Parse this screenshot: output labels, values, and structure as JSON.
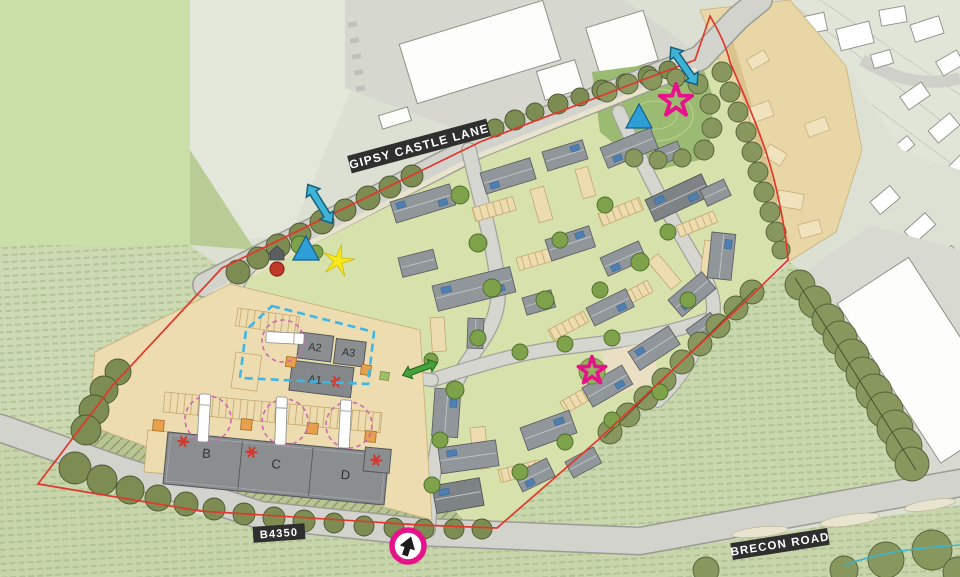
{
  "plan": {
    "road_labels": {
      "gipsy_castle_lane": "GIPSY CASTLE LANE",
      "b4350": "B4350",
      "brecon_road": "BRECON ROAD"
    },
    "building_labels": {
      "a1": "A1",
      "a2": "A2",
      "a3": "A3",
      "b": "B",
      "c": "C",
      "d": "D"
    },
    "markers": {
      "site_boundary": {
        "name": "site-boundary-line",
        "color": "#e0382c",
        "style": "solid"
      },
      "secondary_boundary": {
        "name": "commercial-plot-dashed-boundary",
        "color": "#3fb6e8",
        "style": "dashed"
      },
      "turning_circles": {
        "name": "turning-circle",
        "color": "#cf6ab0",
        "style": "dashed",
        "count": 4
      },
      "cyan_link_arrows": {
        "name": "cyan-double-arrow-marker",
        "color": "#3fb3d6",
        "count": 2
      },
      "green_link_arrow": {
        "name": "green-double-arrow-marker",
        "color": "#45a23c",
        "count": 1
      },
      "blue_triangles": {
        "name": "blue-triangle-marker",
        "color": "#2d9fd6",
        "count": 2
      },
      "pink_stars": {
        "name": "pink-star-marker",
        "color": "#e5128a",
        "count": 2
      },
      "yellow_star": {
        "name": "yellow-star-marker",
        "color": "#f6e81a",
        "count": 1
      },
      "red_dot": {
        "name": "red-circle-marker",
        "color": "#c0392b",
        "count": 1
      },
      "site_access": {
        "name": "site-access-arrow-marker",
        "ring_color": "#e5128a",
        "arrow_color": "#1c1c1c",
        "count": 1
      },
      "unit_asterisks": {
        "name": "unit-asterisk-marker",
        "color": "#d4372c",
        "on_units": [
          "A1",
          "B",
          "C",
          "D"
        ]
      }
    },
    "palette": {
      "field_green": "#cdd9b2",
      "site_green": "#d6e1ac",
      "road_grey": "#d2d3cc",
      "parking_tan": "#ecdcb0",
      "roof_grey": "#90969a",
      "future_phase_tan": "#e9d6a6",
      "tree_olive": "#87975d",
      "solar_blue": "#4d7fb2",
      "dock_orange": "#e8a04c"
    }
  }
}
